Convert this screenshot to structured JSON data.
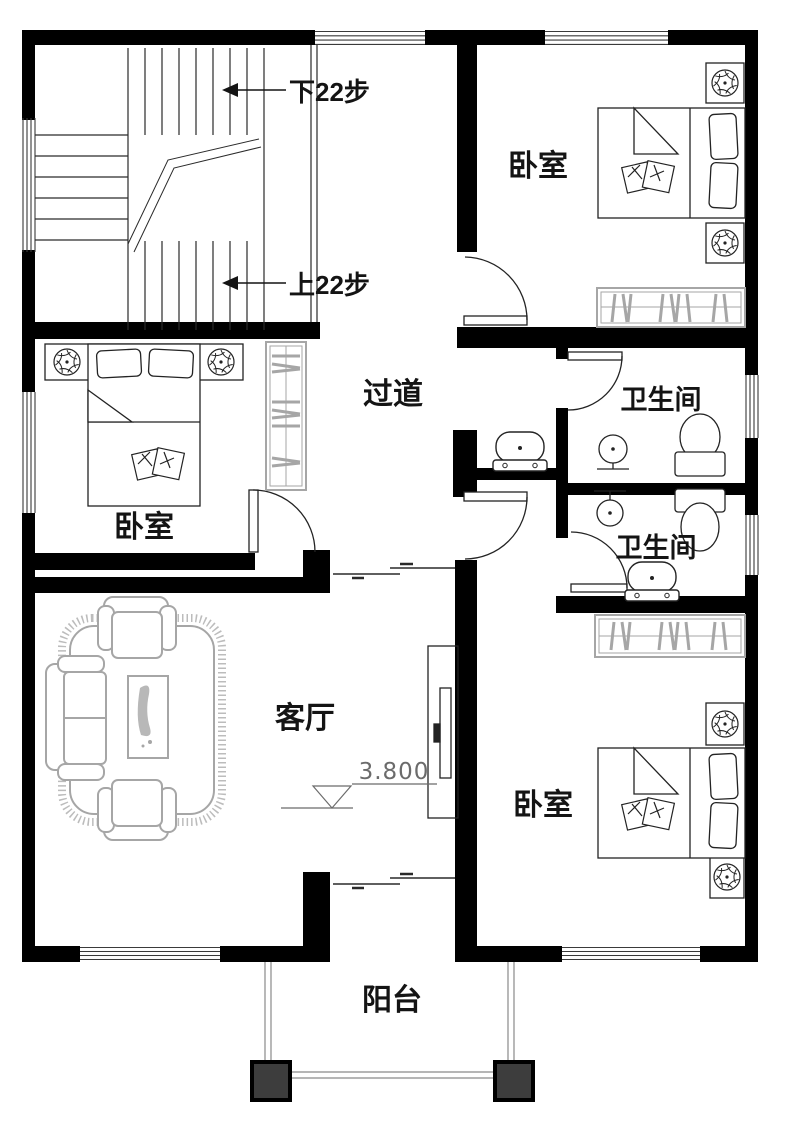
{
  "rooms": {
    "bedroom_top": {
      "label": "卧室"
    },
    "bedroom_left": {
      "label": "卧室"
    },
    "bedroom_bottom": {
      "label": "卧室"
    },
    "hallway": {
      "label": "过道"
    },
    "bathroom_upper": {
      "label": "卫生间"
    },
    "bathroom_lower": {
      "label": "卫生间"
    },
    "living_room": {
      "label": "客厅"
    },
    "balcony": {
      "label": "阳台"
    }
  },
  "stairs": {
    "down_label": "下22步",
    "up_label": "上22步"
  },
  "elevation": {
    "value": "3.800"
  },
  "colors": {
    "wall": "#000000",
    "line": "#2a2a2a",
    "furniture_gray": "#a6a6a6",
    "rug_fringe": "#bcbcbc",
    "column": "#3d3d3d",
    "background": "#ffffff"
  }
}
